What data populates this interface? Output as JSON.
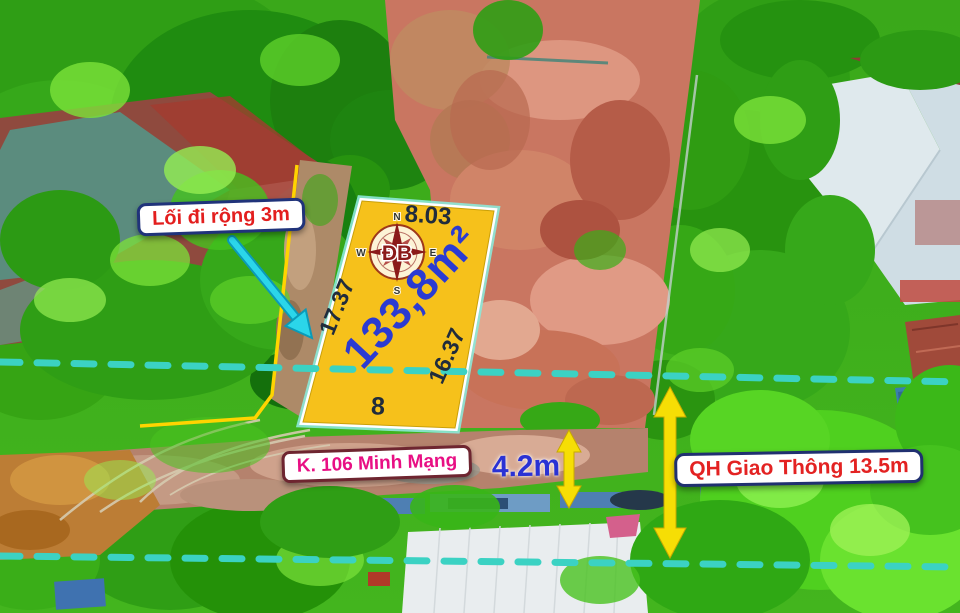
{
  "plot": {
    "area": "133,8m²",
    "dimensions": {
      "top": "8.03",
      "left": "17.37",
      "right": "16.37",
      "bottom": "8"
    }
  },
  "compass": {
    "center": "ĐB",
    "n": "N",
    "e": "E",
    "s": "S",
    "w": "W"
  },
  "callouts": {
    "path": "Lối đi rộng 3m",
    "street": "K. 106 Minh Mạng",
    "road_width": "4.2m",
    "planning": "QH Giao Thông 13.5m"
  },
  "colors": {
    "plot_fill": "#f6c11b",
    "plot_border": "#ffffff",
    "area_text": "#2b3bd2",
    "dimension_text": "#202c3c",
    "dashed_line": "#3bd2c3",
    "cyan_arrow": "#2bd6ea",
    "yellow_arrow": "#f6de05",
    "path_label_text": "#e31e1e",
    "street_label_text": "#e80f84",
    "planning_label_text": "#e32222",
    "navy_border": "#203070",
    "maroon_border": "#6e2530",
    "compass_rose": "#8b1a1a"
  }
}
